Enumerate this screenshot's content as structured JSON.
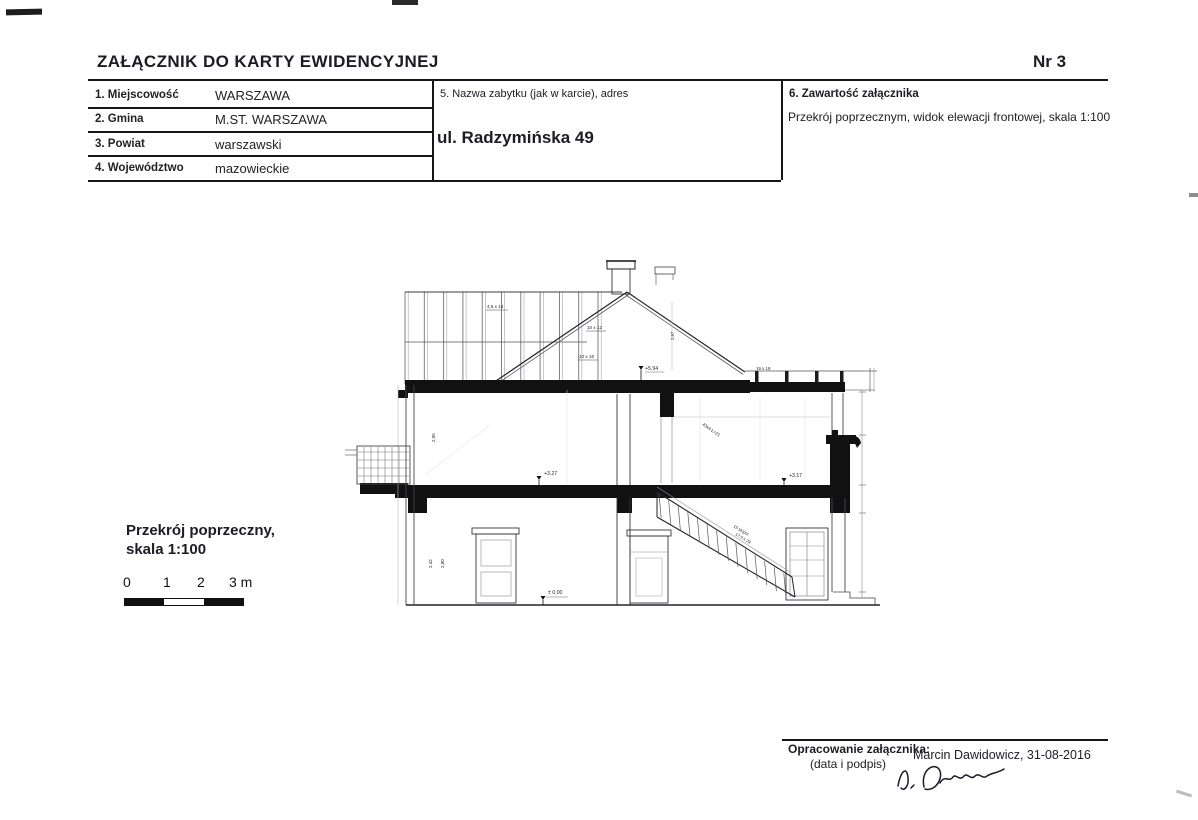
{
  "header": {
    "title": "ZAŁĄCZNIK DO KARTY EWIDENCYJNEJ",
    "number": "Nr 3"
  },
  "table": {
    "rows": [
      {
        "label": "1. Miejscowość",
        "value": "WARSZAWA"
      },
      {
        "label": "2. Gmina",
        "value": "M.ST. WARSZAWA"
      },
      {
        "label": "3. Powiat",
        "value": "warszawski"
      },
      {
        "label": "4. Województwo",
        "value": "mazowieckie"
      }
    ],
    "monument": {
      "label": "5. Nazwa zabytku (jak w karcie), adres",
      "value": "ul. Radzymińska 49"
    },
    "contents": {
      "label": "6. Zawartość załącznika",
      "value": "Przekrój poprzecznym, widok elewacji frontowej, skala 1:100"
    }
  },
  "scale_block": {
    "caption1": "Przekrój poprzeczny,",
    "caption2": "skala 1:100",
    "ticks": [
      "0",
      "1",
      "2",
      "3 m"
    ]
  },
  "drawing_annotations": {
    "level_attic": "+5.94",
    "level_floor_left": "+3.27",
    "level_floor_right": "+3.17",
    "level_ground": "± 0.00",
    "timber_gable": "4,5 x 14",
    "timber_purlin": "10 x 12",
    "timber_tie": "10 x 16",
    "timber_joist": "19 x 18",
    "beam_note": "43x4 Ł=21",
    "stairs_note1": "15 stopni",
    "stairs_note2": "17,5 x 29",
    "dim_room": "2,95",
    "dim_ground1": "2,42",
    "dim_ground2": "2,80",
    "dim_roof": "2,97"
  },
  "footer": {
    "label": "Opracowanie załącznika:",
    "sublabel": "(data i podpis)",
    "author": "Marcin Dawidowicz, 31-08-2016"
  },
  "colors": {
    "ink": "#1c1c24",
    "slab_black": "#111111"
  }
}
